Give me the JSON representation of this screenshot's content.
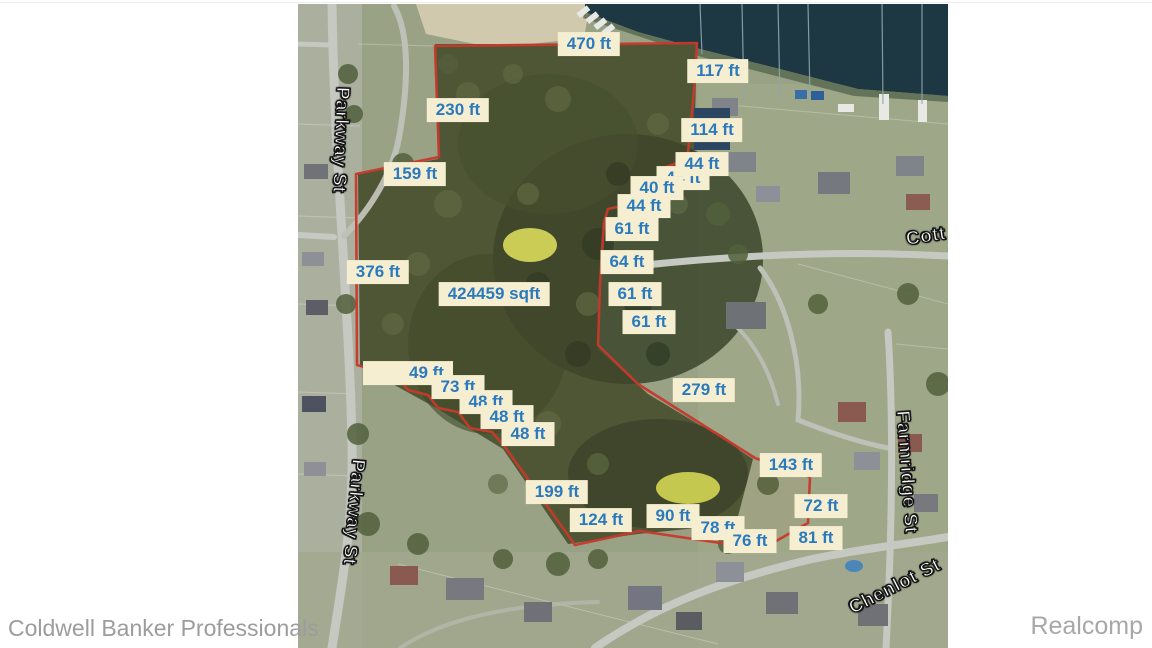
{
  "watermarks": {
    "left": "Coldwell Banker Professionals",
    "right": "Realcomp"
  },
  "map": {
    "parcel_area_label": "424459 sqft",
    "colors": {
      "label_background": "#f6eed1",
      "label_text": "#2b7abe",
      "boundary_red": "#c8392b",
      "water": "#1d3743",
      "street_label_text": "#ffffff",
      "watermark_gray": "#9c9c9c"
    },
    "measurements": [
      {
        "name": "measurement-470ft",
        "text": "470 ft",
        "x": 291,
        "y": 40,
        "z": 3
      },
      {
        "name": "measurement-117ft",
        "text": "117 ft",
        "x": 420,
        "y": 67,
        "z": 3
      },
      {
        "name": "measurement-230ft",
        "text": "230 ft",
        "x": 160,
        "y": 106,
        "z": 3
      },
      {
        "name": "measurement-159ft",
        "text": "159 ft",
        "x": 117,
        "y": 170,
        "z": 3
      },
      {
        "name": "measurement-114ft",
        "text": "114 ft",
        "x": 414,
        "y": 126,
        "z": 3
      },
      {
        "name": "measurement-44ft-a",
        "text": "44 ft",
        "x": 404,
        "y": 160,
        "z": 4
      },
      {
        "name": "measurement-44ft-b",
        "text": "44 ft",
        "x": 385,
        "y": 174,
        "z": 1
      },
      {
        "name": "measurement-40ft",
        "text": "40 ft",
        "x": 359,
        "y": 184,
        "z": 2
      },
      {
        "name": "measurement-44ft-c",
        "text": "44 ft",
        "x": 346,
        "y": 202,
        "z": 3
      },
      {
        "name": "measurement-61ft-a",
        "text": "61 ft",
        "x": 334,
        "y": 225,
        "z": 3
      },
      {
        "name": "measurement-64ft",
        "text": "64 ft",
        "x": 329,
        "y": 258,
        "z": 3
      },
      {
        "name": "measurement-61ft-b",
        "text": "61 ft",
        "x": 337,
        "y": 290,
        "z": 3
      },
      {
        "name": "measurement-61ft-c",
        "text": "61 ft",
        "x": 351,
        "y": 318,
        "z": 3
      },
      {
        "name": "measurement-376ft",
        "text": "376 ft",
        "x": 80,
        "y": 268,
        "z": 3
      },
      {
        "name": "parcel-area-label",
        "text": "424459 sqft",
        "x": 196,
        "y": 290,
        "z": 3
      },
      {
        "name": "measurement-49ft",
        "text": "49 ft",
        "x": 110,
        "y": 369,
        "z": 1,
        "wide": true
      },
      {
        "name": "measurement-73ft",
        "text": "73 ft",
        "x": 160,
        "y": 383,
        "z": 2
      },
      {
        "name": "measurement-48ft-a",
        "text": "48 ft",
        "x": 188,
        "y": 398,
        "z": 3
      },
      {
        "name": "measurement-48ft-b",
        "text": "48 ft",
        "x": 209,
        "y": 413,
        "z": 4
      },
      {
        "name": "measurement-48ft-c",
        "text": "48 ft",
        "x": 230,
        "y": 430,
        "z": 5
      },
      {
        "name": "measurement-279ft",
        "text": "279 ft",
        "x": 406,
        "y": 386,
        "z": 3
      },
      {
        "name": "measurement-199ft",
        "text": "199 ft",
        "x": 259,
        "y": 488,
        "z": 3
      },
      {
        "name": "measurement-124ft",
        "text": "124 ft",
        "x": 303,
        "y": 516,
        "z": 1
      },
      {
        "name": "measurement-90ft",
        "text": "90 ft",
        "x": 375,
        "y": 512,
        "z": 2
      },
      {
        "name": "measurement-78ft",
        "text": "78 ft",
        "x": 420,
        "y": 524,
        "z": 1
      },
      {
        "name": "measurement-76ft",
        "text": "76 ft",
        "x": 452,
        "y": 537,
        "z": 2
      },
      {
        "name": "measurement-81ft",
        "text": "81 ft",
        "x": 518,
        "y": 534,
        "z": 3
      },
      {
        "name": "measurement-72ft",
        "text": "72 ft",
        "x": 523,
        "y": 502,
        "z": 3
      },
      {
        "name": "measurement-143ft",
        "text": "143 ft",
        "x": 493,
        "y": 461,
        "z": 3
      }
    ],
    "streets": [
      {
        "name": "street-label-parkway-st-north",
        "text": "Parkway St",
        "x": 42,
        "y": 136,
        "rot": 92
      },
      {
        "name": "street-label-parkway-st-south",
        "text": "Parkway St",
        "x": 55,
        "y": 508,
        "rot": 95
      },
      {
        "name": "street-label-farmridge-st",
        "text": "Farmridge St",
        "x": 608,
        "y": 468,
        "rot": 86
      },
      {
        "name": "street-label-chenlot-st",
        "text": "Chenlot St",
        "x": 597,
        "y": 583,
        "rot": -27
      },
      {
        "name": "street-label-cott",
        "text": "Cott",
        "x": 628,
        "y": 233,
        "rot": -9
      }
    ]
  }
}
